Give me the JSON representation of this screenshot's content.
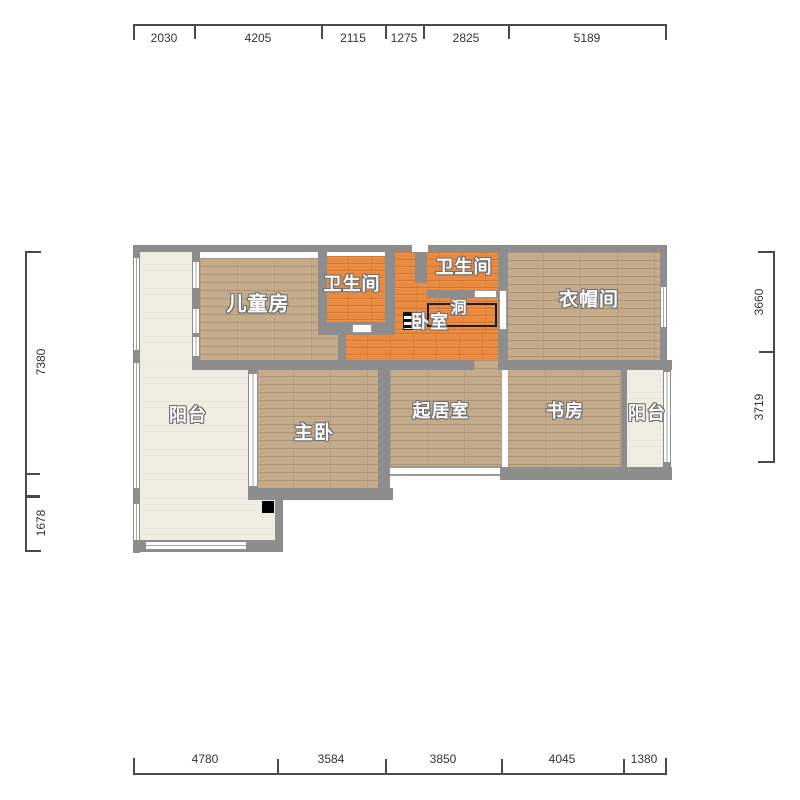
{
  "plan": {
    "type": "apartment-floor-plan",
    "rooms": {
      "children": {
        "label": "儿童房"
      },
      "bath_left": {
        "label": "卫生间"
      },
      "bath_right": {
        "label": "卫生间"
      },
      "bedroom": {
        "label": "卧室"
      },
      "hole": {
        "label": "洞"
      },
      "cloakroom": {
        "label": "衣帽间"
      },
      "balcony_left": {
        "label": "阳台"
      },
      "master": {
        "label": "主卧"
      },
      "living": {
        "label": "起居室"
      },
      "study": {
        "label": "书房"
      },
      "balcony_right": {
        "label": "阳台"
      }
    },
    "dimensions": {
      "top": [
        "2030",
        "4205",
        "2115",
        "1275",
        "2825",
        "5189"
      ],
      "bottom": [
        "4780",
        "3584",
        "3850",
        "4045",
        "1380"
      ],
      "left": [
        "7380",
        "1678"
      ],
      "right": [
        "3660",
        "3719"
      ]
    },
    "colors": {
      "wall": "#8d8d8d",
      "floor_wood_tan": "#c4ab8b",
      "floor_wood_orange": "#e98a40",
      "floor_balcony_cream": "#f0ede3",
      "hole_outline": "#1a1a1a",
      "dimension_text": "#333333"
    }
  }
}
